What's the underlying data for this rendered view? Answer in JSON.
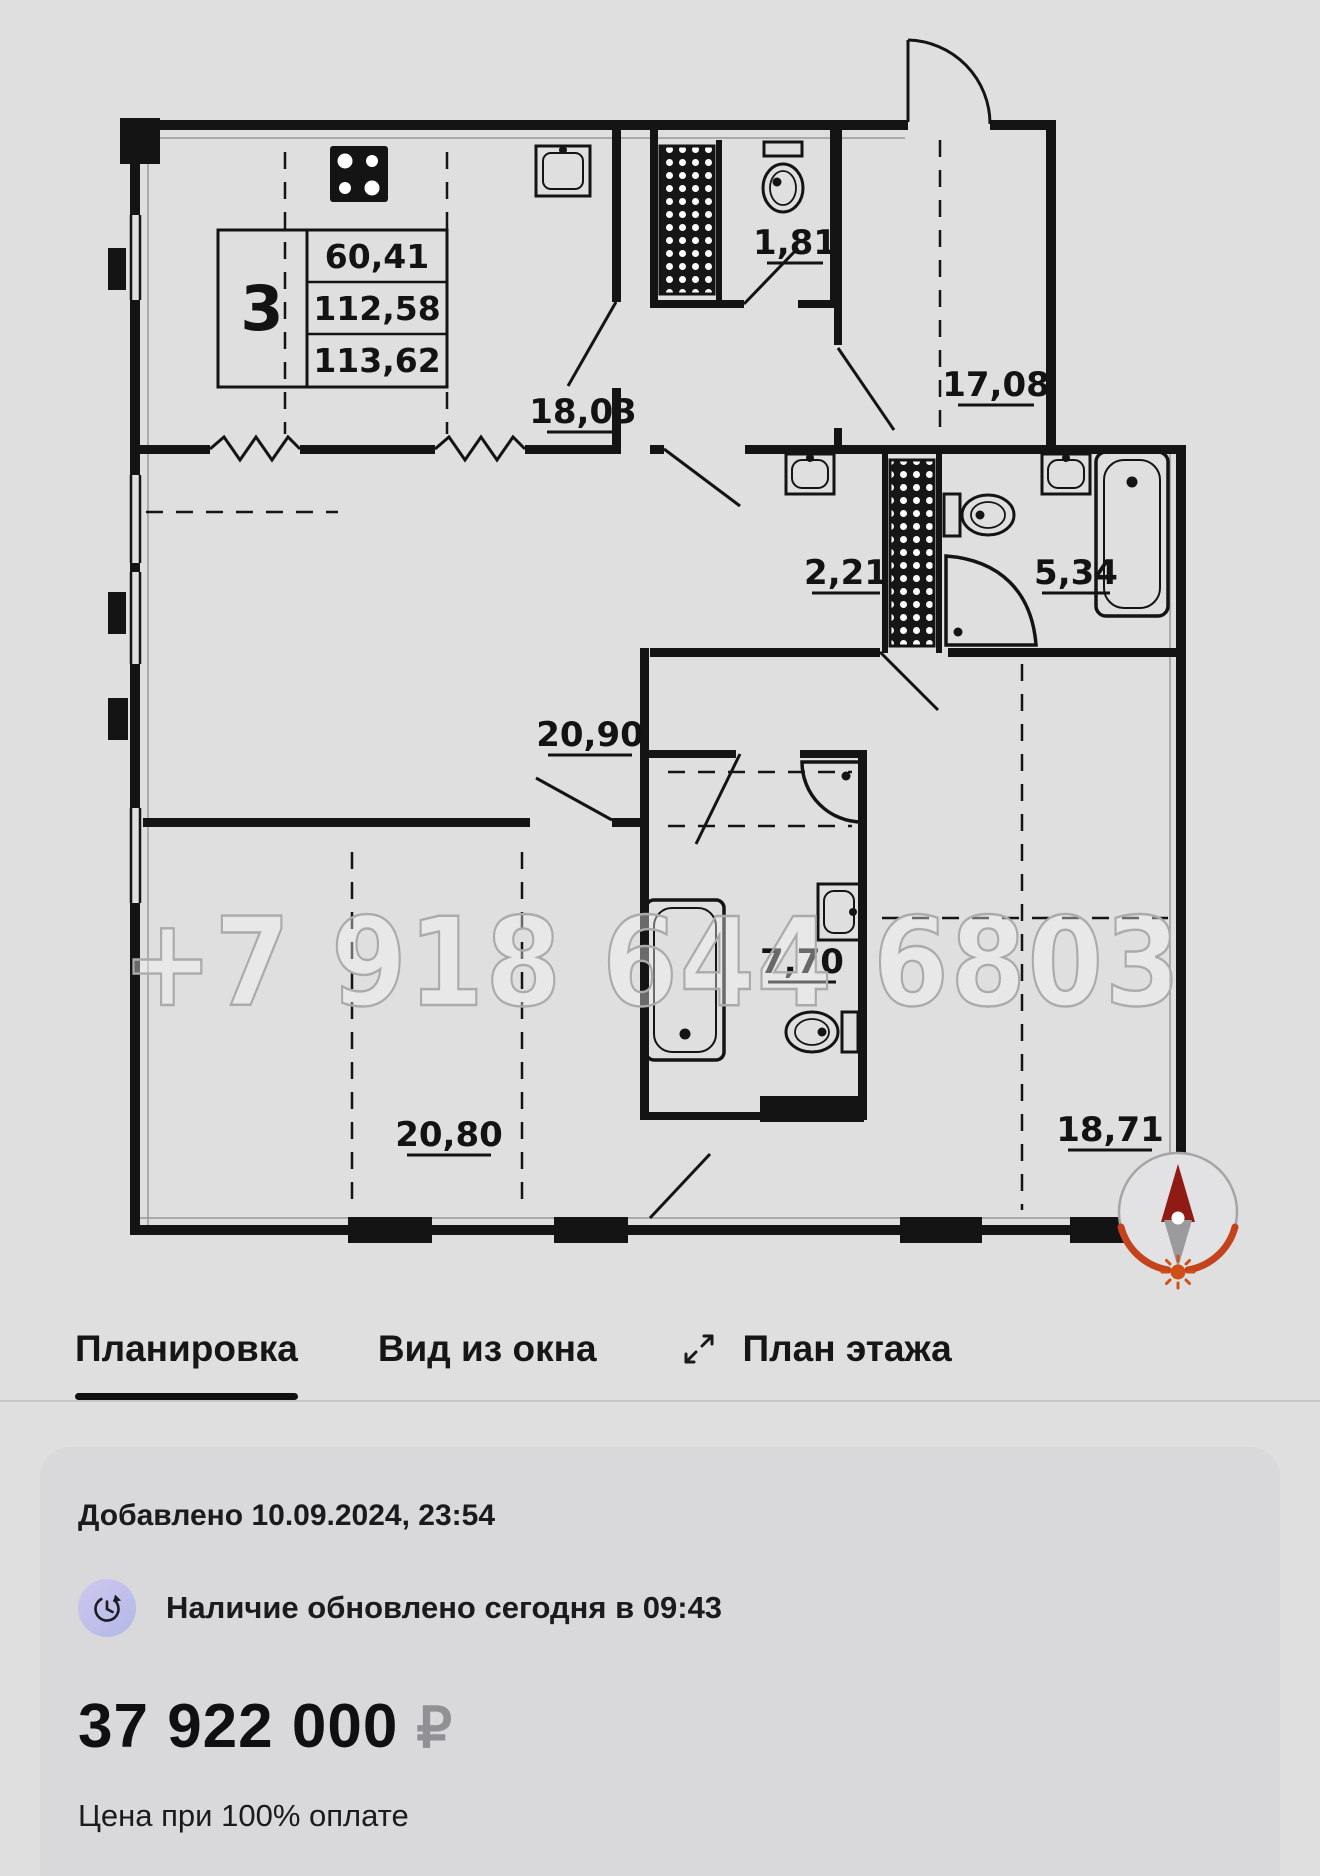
{
  "floor_plan": {
    "watermark": "+7 918 644 6803",
    "info_table": {
      "room_count": "3",
      "values": [
        "60,41",
        "112,58",
        "113,62"
      ]
    },
    "areas": {
      "kitchen": "18,03",
      "wc": "1,81",
      "bedroom_top_right": "17,08",
      "closet": "2,21",
      "bathroom_right": "5,34",
      "hall": "20,90",
      "bathroom_middle": "7,70",
      "bedroom_bottom_left": "20,80",
      "bedroom_bottom_right": "18,71"
    },
    "compass": {
      "needle_color": "#8f1b14",
      "arc_color": "#c2431c"
    }
  },
  "tabs": [
    {
      "label": "Планировка",
      "active": true
    },
    {
      "label": "Вид из окна",
      "active": false
    },
    {
      "label": "План этажа",
      "active": false
    }
  ],
  "details": {
    "added": "Добавлено 10.09.2024, 23:54",
    "availability": "Наличие обновлено сегодня в 09:43",
    "price": "37 922 000",
    "currency": "₽",
    "price_note": "Цена при 100% оплате"
  }
}
